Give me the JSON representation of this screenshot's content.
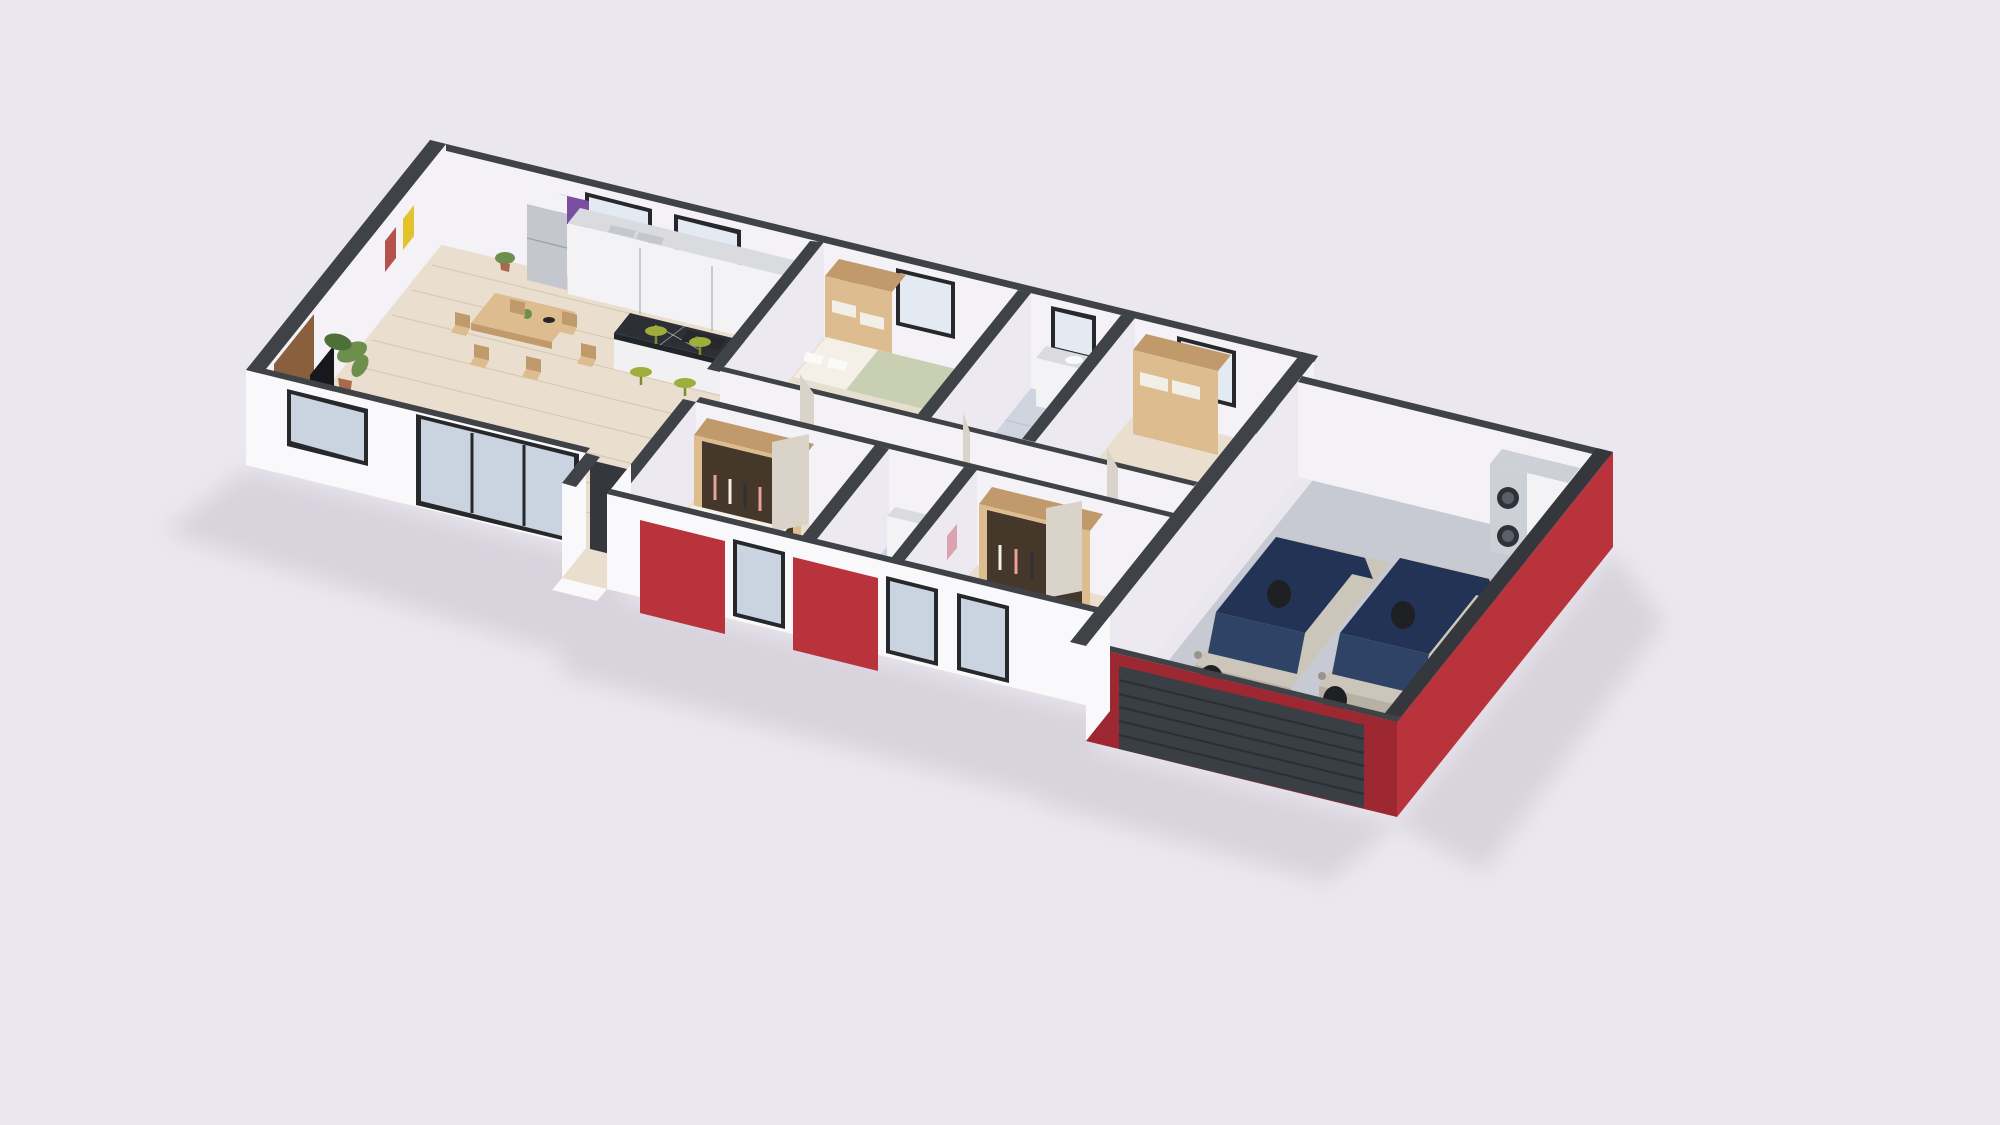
{
  "scene": {
    "type": "isometric-3d-floor-plan-render",
    "description": "3D cutaway floor plan of a single-story house with open living-dining-kitchen, four bedrooms, two bathrooms, hallway, entry porch and an attached double garage with two cars and a stacked washer-dryer. White walls with dark charcoal wall caps and red accent facade panels on a pale lavender background.",
    "rooms": [
      {
        "name": "living-dining-room",
        "furniture": [
          "tv-console",
          "wall-mounted-tv",
          "wood-accent-wall",
          "dining-table-pair",
          "six-dining-chairs",
          "banana-plant",
          "corner-plant",
          "desk-and-chair",
          "yellow-art",
          "abstract-art",
          "purple-art"
        ]
      },
      {
        "name": "kitchen",
        "furniture": [
          "fridge",
          "counter-run-with-double-sink",
          "marble-island-with-gas-cooktop",
          "four-green-bar-stools",
          "back-windows"
        ]
      },
      {
        "name": "bedroom-back-left",
        "furniture": [
          "double-bed-sage-blanket",
          "open-wardrobe-with-linen",
          "sunflower-art",
          "window"
        ]
      },
      {
        "name": "bathroom-central",
        "furniture": [
          "vanity-with-sink",
          "toilet",
          "dark-tiled-shower",
          "window"
        ]
      },
      {
        "name": "bedroom-back-right",
        "furniture": [
          "double-bed",
          "open-wardrobe-with-linen",
          "landscape-art",
          "window"
        ]
      },
      {
        "name": "hallway",
        "furniture": [
          "open-doors"
        ]
      },
      {
        "name": "bedroom-front-left",
        "furniture": [
          "double-bed",
          "open-wardrobe-with-clothes",
          "ocean-art",
          "front-window"
        ]
      },
      {
        "name": "bathroom-front",
        "furniture": [
          "vanity",
          "toilet",
          "tiled-floor",
          "front-window"
        ]
      },
      {
        "name": "bedroom-front-right",
        "furniture": [
          "double-bed",
          "open-wardrobe-with-clothes",
          "pink-art",
          "front-window"
        ]
      },
      {
        "name": "entry-porch",
        "furniture": [
          "step",
          "dark-doorway"
        ]
      },
      {
        "name": "double-garage",
        "furniture": [
          "car-left",
          "car-right",
          "stacked-washer-dryer",
          "white-cabinet",
          "sectional-garage-door"
        ]
      }
    ],
    "exterior_features": [
      "red-accent-panels",
      "dark-charcoal-wall-caps",
      "black-framed-windows",
      "sliding-glass-door",
      "soft-ground-shadow"
    ]
  },
  "p": {
    "bg": "#eae7ee",
    "shadow": "#c9c2cf",
    "cap": "#3f4246",
    "capDark": "#34373b",
    "wallLit": "#f9f8fa",
    "wallMid": "#eceaf0",
    "wallInner": "#f4f2f6",
    "wallShade": "#e3e0e9",
    "red": "#b8333b",
    "redDeep": "#9e2831",
    "frame": "#26282b",
    "glass": "#e3eaf2",
    "glassFront": "#c9d4e0",
    "woodFloor": "#eadfcf",
    "plank": "#d7c9b3",
    "tile": "#cfd5df",
    "tileLine": "#b7bfcc",
    "showerDark": "#474d56",
    "garageFloor": "#c7cad3",
    "counterTop": "#d9dbdf",
    "cabinet": "#f3f2f4",
    "steel": "#c4c7cd",
    "steelDark": "#9aa0a8",
    "islandTop": "#2c2f35",
    "islandEdge": "#212429",
    "islandBase": "#f1f0f3",
    "woodFurn": "#ddbd8f",
    "woodFurnDark": "#c09a6a",
    "woodDark": "#8a5f3e",
    "green": "#9fae3a",
    "greenDark": "#7e8c2e",
    "sage": "#c9cfb2",
    "blanket": "#e6dfd0",
    "mattress": "#f4f0e7",
    "pillow": "#fbfaf6",
    "tv": "#16181b",
    "consoleDark": "#232529",
    "wardrobeIn": "#453729",
    "clothesPink": "#e8a29a",
    "clothesWhite": "#f2efe9",
    "clothesDark": "#2e3036",
    "artYellow": "#e3c32c",
    "artGreen": "#5a8a3c",
    "artMulti": "#7a4fa0",
    "artRed": "#b5524d",
    "artBlue": "#4a7fae",
    "artPink": "#d9a3b0",
    "carBodyLit": "#ccc5b9",
    "carBody": "#b7b0a4",
    "carBodyShade": "#9a948a",
    "carGlass": "#223355",
    "carGlassLit": "#2e4366",
    "wheel": "#1e2023",
    "washer": "#cdd0d6",
    "washerDoor": "#2f3237",
    "washerDoorIn": "#5a606a",
    "door": "#d9d3ca",
    "garageDoor": "#3a3e45",
    "garageSlat": "#2b2e34",
    "plantG": "#6d8f4e",
    "plantD": "#4e7038",
    "pot": "#a9694a",
    "bowl": "#26272b"
  }
}
